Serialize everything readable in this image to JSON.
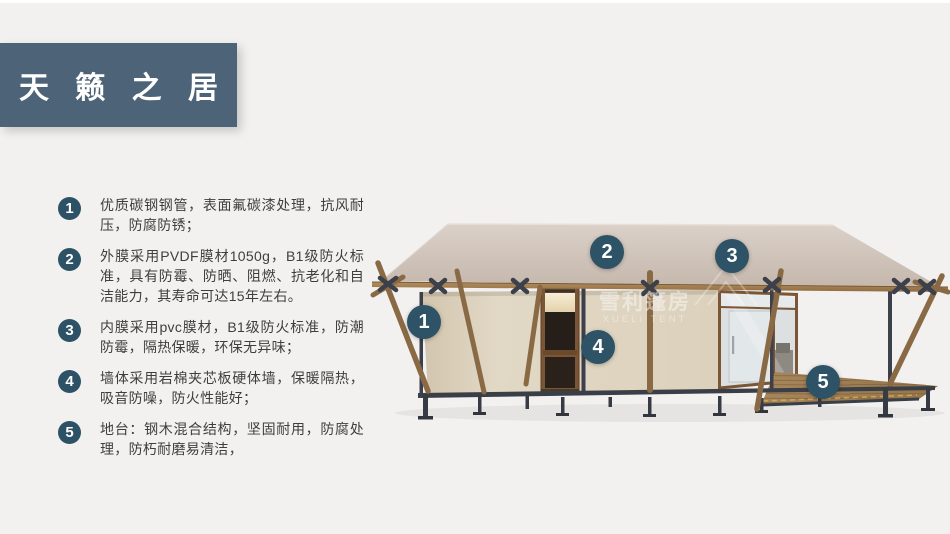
{
  "slide": {
    "title": "天 籁 之 居"
  },
  "features": [
    {
      "num": "1",
      "text": "优质碳钢钢管，表面氟碳漆处理，抗风耐压，防腐防锈；"
    },
    {
      "num": "2",
      "text": "外膜采用PVDF膜材1050g，B1级防火标准，具有防霉、防晒、阻燃、抗老化和自洁能力，其寿命可达15年左右。"
    },
    {
      "num": "3",
      "text": "内膜采用pvc膜材，B1级防火标准，防潮防霉，隔热保暖，环保无异味；"
    },
    {
      "num": "4",
      "text": "墙体采用岩棉夹芯板硬体墙，保暖隔热，吸音防噪，防火性能好；"
    },
    {
      "num": "5",
      "text": "地台：钢木混合结构，坚固耐用，防腐处理，防朽耐磨易清洁，"
    }
  ],
  "diagram": {
    "markers": [
      {
        "num": "1",
        "x": 424,
        "y": 322
      },
      {
        "num": "2",
        "x": 607,
        "y": 252
      },
      {
        "num": "3",
        "x": 732,
        "y": 256
      },
      {
        "num": "4",
        "x": 598,
        "y": 347
      },
      {
        "num": "5",
        "x": 823,
        "y": 382
      }
    ],
    "watermark": {
      "cn": "雪利篷房",
      "en": "XUELI TENT"
    }
  },
  "colors": {
    "background": "#f2f1f0",
    "title_bg": "#4d6377",
    "badge": "#2e5366",
    "list_bullet": "#2d5266",
    "body_text": "#3e3e3e",
    "roof": "#d0c4ba",
    "wall": "#ded4c0",
    "wood": "#8a6a45",
    "steel": "#3a3f48",
    "deck": "#a07c50"
  }
}
